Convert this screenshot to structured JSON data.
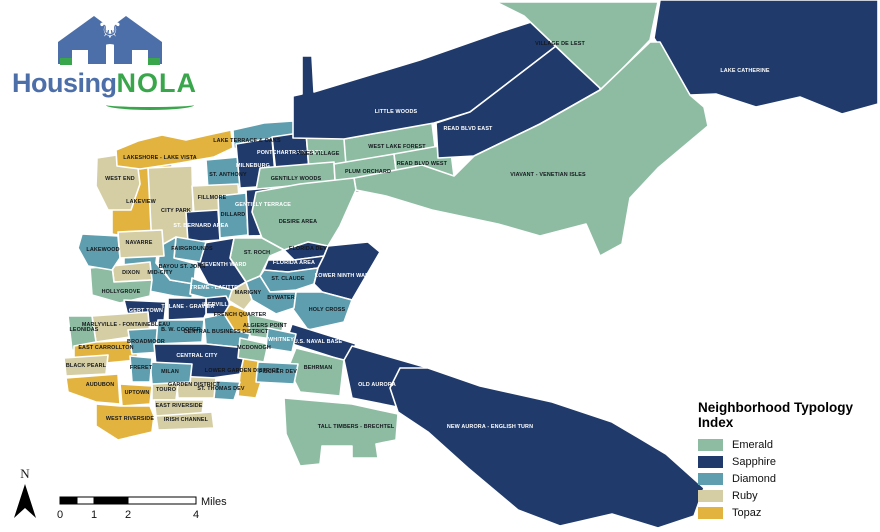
{
  "logo": {
    "brand_housing": "Housing",
    "brand_nola": "NOLA",
    "icon": "housing-nola-house-fleur-de-lis-icon",
    "blue": "#4d6fa9",
    "green": "#3aa64c"
  },
  "north_arrow": {
    "label": "N"
  },
  "scale_bar": {
    "ticks": [
      "0",
      "1",
      "2",
      "4"
    ],
    "unit": "Miles"
  },
  "legend": {
    "title": "Neighborhood Typology Index",
    "items": [
      {
        "key": "emerald",
        "label": "Emerald"
      },
      {
        "key": "sapphire",
        "label": "Sapphire"
      },
      {
        "key": "diamond",
        "label": "Diamond"
      },
      {
        "key": "ruby",
        "label": "Ruby"
      },
      {
        "key": "topaz",
        "label": "Topaz"
      }
    ]
  },
  "map": {
    "width": 880,
    "height": 532,
    "background": "#ffffff",
    "typology_colors": {
      "emerald": "#8dbca2",
      "sapphire": "#1f3a6b",
      "diamond": "#5e9eaf",
      "ruby": "#d5cea4",
      "topaz": "#e2b33e"
    },
    "label_dark": "#15181d",
    "label_light": "#ffffff",
    "regions": [
      {
        "id": "lakeview",
        "name": "LAKEVIEW",
        "typology": "topaz",
        "label": [
          141,
          203
        ],
        "white": false,
        "pts": "112,172 137,168 172,164 174,237 144,240 112,234"
      },
      {
        "id": "west-end",
        "name": "WEST END",
        "typology": "ruby",
        "label": [
          120,
          180
        ],
        "white": false,
        "pts": "97,158 136,152 140,184 131,210 108,210 96,186"
      },
      {
        "id": "lakeshore-lake-vista",
        "name": "LAKESHORE - LAKE VISTA",
        "typology": "topaz",
        "label": [
          160,
          159
        ],
        "white": false,
        "pts": "116,150 138,141 162,135 186,140 208,135 231,130 233,148 214,157 180,163 140,169 117,166"
      },
      {
        "id": "lake-terrace-oaks",
        "name": "LAKE TERRACE & OAKS",
        "typology": "diamond",
        "label": [
          247,
          142
        ],
        "white": false,
        "pts": "233,130 264,123 293,121 297,137 278,149 252,155 234,148"
      },
      {
        "id": "city-park",
        "name": "CITY PARK",
        "typology": "ruby",
        "label": [
          176,
          212
        ],
        "white": false,
        "pts": "148,168 192,166 194,250 152,248"
      },
      {
        "id": "st-anthony",
        "name": "ST. ANTHONY",
        "typology": "diamond",
        "label": [
          228,
          176
        ],
        "white": false,
        "pts": "206,160 250,156 252,188 208,190"
      },
      {
        "id": "fillmore",
        "name": "FILLMORE",
        "typology": "ruby",
        "label": [
          212,
          199
        ],
        "white": false,
        "pts": "192,186 238,184 240,212 194,214"
      },
      {
        "id": "milneburg",
        "name": "MILNEBURG",
        "typology": "sapphire",
        "label": [
          253,
          167
        ],
        "white": true,
        "pts": "236,144 272,138 276,186 240,188"
      },
      {
        "id": "pontchartrain-park",
        "name": "PONTCHARTRAIN PARK",
        "typology": "sapphire",
        "label": [
          290,
          154
        ],
        "white": true,
        "pts": "272,137 306,132 309,170 276,173"
      },
      {
        "id": "pines-village",
        "name": "PINES VILLAGE",
        "typology": "emerald",
        "label": [
          318,
          155
        ],
        "white": false,
        "pts": "306,132 350,128 352,168 309,170"
      },
      {
        "id": "gentilly-woods",
        "name": "GENTILLY WOODS",
        "typology": "emerald",
        "label": [
          296,
          180
        ],
        "white": false,
        "pts": "260,168 334,162 336,194 300,186 256,190"
      },
      {
        "id": "st-bernard-area",
        "name": "ST. BERNARD AREA",
        "typology": "sapphire",
        "label": [
          201,
          227
        ],
        "white": true,
        "pts": "186,212 218,210 220,240 188,242"
      },
      {
        "id": "dillard",
        "name": "DILLARD",
        "typology": "diamond",
        "label": [
          233,
          216
        ],
        "white": false,
        "pts": "218,196 246,193 248,235 220,238"
      },
      {
        "id": "gentilly-terrace",
        "name": "GENTILLY TERRACE",
        "typology": "sapphire",
        "label": [
          263,
          206
        ],
        "white": true,
        "pts": "246,190 290,186 292,235 248,236"
      },
      {
        "id": "west-lake-forest",
        "name": "WEST LAKE FOREST",
        "typology": "emerald",
        "label": [
          397,
          148
        ],
        "white": false,
        "pts": "344,139 432,123 436,155 396,162 346,165"
      },
      {
        "id": "plum-orchard",
        "name": "PLUM ORCHARD",
        "typology": "emerald",
        "label": [
          368,
          173
        ],
        "white": false,
        "pts": "334,164 394,154 398,186 336,196"
      },
      {
        "id": "read-blvd-west",
        "name": "READ BLVD WEST",
        "typology": "emerald",
        "label": [
          422,
          165
        ],
        "white": false,
        "pts": "394,154 450,144 454,176 398,186"
      },
      {
        "id": "little-woods",
        "name": "LITTLE WOODS",
        "typology": "sapphire",
        "label": [
          396,
          113
        ],
        "white": true,
        "pts": "293,96 302,94 302,56 312,56 314,92 420,60 500,32 578,7 592,5 590,20 470,112 434,123 344,139 293,138"
      },
      {
        "id": "read-blvd-east",
        "name": "READ BLVD EAST",
        "typology": "sapphire",
        "label": [
          468,
          130
        ],
        "white": true,
        "pts": "590,20 602,30 600,90 540,124 474,156 438,158 436,123 470,112"
      },
      {
        "id": "village-de-lest",
        "name": "VILLAGE DE LEST",
        "typology": "emerald",
        "label": [
          560,
          45
        ],
        "white": false,
        "pts": "496,2 658,2 650,40 602,90 572,62 524,16"
      },
      {
        "id": "lake-catherine",
        "name": "LAKE CATHERINE",
        "typology": "sapphire",
        "label": [
          745,
          72
        ],
        "white": true,
        "pts": "660,0 878,0 878,104 842,114 800,97 756,107 716,94 690,95 654,38"
      },
      {
        "id": "viavant-venetian-isles",
        "name": "VIAVANT - VENETIAN ISLES",
        "typology": "emerald",
        "label": [
          548,
          176
        ],
        "white": false,
        "pts": "354,178 422,165 454,176 474,156 540,124 600,90 650,42 660,42 690,95 704,107 708,126 658,168 630,198 622,244 600,256 586,224 540,236 498,224 432,210 386,196 356,190"
      },
      {
        "id": "desire-area",
        "name": "DESIRE AREA",
        "typology": "emerald",
        "label": [
          298,
          223
        ],
        "white": false,
        "pts": "256,192 300,184 354,178 356,190 340,226 328,246 308,242 284,250 262,238 252,212"
      },
      {
        "id": "st-roch",
        "name": "ST. ROCH",
        "typology": "emerald",
        "label": [
          257,
          254
        ],
        "white": false,
        "pts": "234,238 262,238 284,250 270,256 266,264 260,276 246,282 230,258"
      },
      {
        "id": "seventh-ward",
        "name": "SEVENTH WARD",
        "typology": "sapphire",
        "label": [
          224,
          266
        ],
        "white": true,
        "pts": "204,243 234,238 230,258 246,282 232,290 208,284 196,262"
      },
      {
        "id": "mid-city",
        "name": "MID-CITY",
        "typology": "diamond",
        "label": [
          160,
          274
        ],
        "white": false,
        "pts": "124,252 158,246 156,263 170,280 194,284 192,298 174,296 124,286"
      },
      {
        "id": "fairgrounds",
        "name": "FAIRGROUNDS",
        "typology": "diamond",
        "label": [
          192,
          250
        ],
        "white": false,
        "pts": "176,237 206,242 200,262 174,258"
      },
      {
        "id": "bayou-st-john",
        "name": "BAYOU ST. JOHN",
        "typology": "diamond",
        "label": [
          182,
          268
        ],
        "white": false,
        "pts": "160,246 176,237 174,258 196,264 194,284 170,280 158,263"
      },
      {
        "id": "florida-dev",
        "name": "FLORIDA DEV",
        "typology": "sapphire",
        "label": [
          308,
          250
        ],
        "white": false,
        "pts": "284,250 308,242 328,246 324,256 294,260"
      },
      {
        "id": "florida-area",
        "name": "FLORIDA AREA",
        "typology": "sapphire",
        "label": [
          294,
          264
        ],
        "white": true,
        "pts": "264,270 268,260 294,260 324,256 318,268 288,272"
      },
      {
        "id": "st-claude",
        "name": "ST. CLAUDE",
        "typology": "diamond",
        "label": [
          288,
          280
        ],
        "white": false,
        "pts": "260,276 264,270 288,272 318,268 314,284 296,290 270,292"
      },
      {
        "id": "lower-ninth-ward",
        "name": "LOWER NINTH WARD",
        "typology": "sapphire",
        "label": [
          344,
          277
        ],
        "white": true,
        "pts": "318,268 324,256 328,246 368,242 380,252 352,300 322,292 314,284"
      },
      {
        "id": "holy-cross",
        "name": "HOLY CROSS",
        "typology": "diamond",
        "label": [
          327,
          311
        ],
        "white": false,
        "pts": "296,292 322,292 352,300 344,322 308,330 292,308"
      },
      {
        "id": "bywater",
        "name": "BYWATER",
        "typology": "diamond",
        "label": [
          281,
          299
        ],
        "white": false,
        "pts": "246,282 260,276 270,292 296,292 294,308 276,314 252,300"
      },
      {
        "id": "marigny",
        "name": "MARIGNY",
        "typology": "ruby",
        "label": [
          248,
          294
        ],
        "white": false,
        "pts": "232,290 246,282 252,300 244,310 228,300"
      },
      {
        "id": "dixon",
        "name": "DIXON",
        "typology": "ruby",
        "label": [
          131,
          274
        ],
        "white": false,
        "pts": "112,266 150,262 152,280 114,282"
      },
      {
        "id": "hollygrove",
        "name": "HOLLYGROVE",
        "typology": "emerald",
        "label": [
          121,
          293
        ],
        "white": false,
        "pts": "90,268 112,266 114,282 152,280 150,296 120,303 92,295"
      },
      {
        "id": "treme-lafitte",
        "name": "TREME - LAFITTE",
        "typology": "diamond",
        "label": [
          214,
          289
        ],
        "white": true,
        "pts": "192,278 208,284 232,290 228,302 206,298 190,294"
      },
      {
        "id": "iberville",
        "name": "IBERVILLE",
        "typology": "sapphire",
        "label": [
          217,
          306
        ],
        "white": true,
        "pts": "206,298 226,296 230,304 224,314 206,314"
      },
      {
        "id": "french-quarter",
        "name": "FRENCH QUARTER",
        "typology": "topaz",
        "label": [
          240,
          316
        ],
        "white": false,
        "pts": "230,304 244,310 256,316 250,334 234,330 224,314"
      },
      {
        "id": "tulane-gravier",
        "name": "TULANE - GRAVIER",
        "typology": "sapphire",
        "label": [
          188,
          308
        ],
        "white": true,
        "pts": "168,298 206,298 206,314 204,318 168,320"
      },
      {
        "id": "gert-town",
        "name": "GERT TOWN",
        "typology": "sapphire",
        "label": [
          146,
          312
        ],
        "white": true,
        "pts": "124,300 166,302 164,322 130,324"
      },
      {
        "id": "marlyville-fontainebleau",
        "name": "MARLYVILLE - FONTAINEBLEAU",
        "typology": "ruby",
        "label": [
          126,
          326
        ],
        "white": false,
        "pts": "92,316 148,312 150,334 96,342"
      },
      {
        "id": "leonidas",
        "name": "LEONIDAS",
        "typology": "emerald",
        "label": [
          84,
          331
        ],
        "white": false,
        "pts": "68,316 92,316 96,342 94,354 72,350"
      },
      {
        "id": "east-carrollton",
        "name": "EAST CARROLLTON",
        "typology": "topaz",
        "label": [
          106,
          349
        ],
        "white": false,
        "pts": "74,346 96,342 136,340 138,360 96,364 74,358"
      },
      {
        "id": "broadmoor",
        "name": "BROADMOOR",
        "typology": "diamond",
        "label": [
          146,
          343
        ],
        "white": false,
        "pts": "128,330 164,328 162,352 132,354"
      },
      {
        "id": "b-w-cooper",
        "name": "B. W. COOPER",
        "typology": "diamond",
        "label": [
          181,
          331
        ],
        "white": false,
        "pts": "158,320 204,320 202,342 156,344"
      },
      {
        "id": "central-business-district",
        "name": "CENTRAL BUSINESS DISTRICT",
        "typology": "diamond",
        "label": [
          226,
          333
        ],
        "white": false,
        "pts": "204,318 224,314 234,330 250,334 246,348 206,344"
      },
      {
        "id": "central-city",
        "name": "CENTRAL CITY",
        "typology": "sapphire",
        "label": [
          197,
          357
        ],
        "white": true,
        "pts": "154,344 206,344 246,348 240,374 198,380 156,366"
      },
      {
        "id": "lower-garden-district",
        "name": "LOWER GARDEN DISTRICT",
        "typology": "topaz",
        "label": [
          242,
          372
        ],
        "white": false,
        "pts": "246,348 258,342 266,366 256,398 238,396 240,374"
      },
      {
        "id": "st-thomas-dev",
        "name": "ST. THOMAS DEV",
        "typology": "diamond",
        "label": [
          221,
          390
        ],
        "white": false,
        "pts": "204,380 240,382 234,400 202,398"
      },
      {
        "id": "garden-district",
        "name": "GARDEN DISTRICT",
        "typology": "ruby",
        "label": [
          194,
          386
        ],
        "white": false,
        "pts": "176,376 216,378 214,398 178,398"
      },
      {
        "id": "touro",
        "name": "TOURO",
        "typology": "ruby",
        "label": [
          166,
          391
        ],
        "white": false,
        "pts": "152,382 178,384 176,400 152,400"
      },
      {
        "id": "milan",
        "name": "MILAN",
        "typology": "diamond",
        "label": [
          170,
          373
        ],
        "white": false,
        "pts": "150,362 192,364 190,382 152,384"
      },
      {
        "id": "freret",
        "name": "FRERET",
        "typology": "diamond",
        "label": [
          141,
          369
        ],
        "white": false,
        "pts": "130,356 152,358 150,382 132,382"
      },
      {
        "id": "uptown",
        "name": "UPTOWN",
        "typology": "topaz",
        "label": [
          137,
          394
        ],
        "white": false,
        "pts": "120,384 152,386 150,404 122,406"
      },
      {
        "id": "audubon",
        "name": "AUDUBON",
        "typology": "topaz",
        "label": [
          100,
          386
        ],
        "white": false,
        "pts": "66,378 118,374 120,404 96,402 68,392"
      },
      {
        "id": "black-pearl",
        "name": "BLACK PEARL",
        "typology": "ruby",
        "label": [
          86,
          367
        ],
        "white": false,
        "pts": "64,358 108,355 106,374 66,376"
      },
      {
        "id": "east-riverside",
        "name": "EAST RIVERSIDE",
        "typology": "ruby",
        "label": [
          179,
          407
        ],
        "white": false,
        "pts": "154,400 204,400 202,414 156,416"
      },
      {
        "id": "irish-channel",
        "name": "IRISH CHANNEL",
        "typology": "ruby",
        "label": [
          186,
          421
        ],
        "white": false,
        "pts": "156,416 212,412 214,428 158,430"
      },
      {
        "id": "west-riverside",
        "name": "WEST RIVERSIDE",
        "typology": "topaz",
        "label": [
          130,
          420
        ],
        "white": false,
        "pts": "96,404 120,406 150,406 154,416 152,432 118,440 96,426"
      },
      {
        "id": "lakewood",
        "name": "LAKEWOOD",
        "typology": "diamond",
        "label": [
          103,
          251
        ],
        "white": false,
        "pts": "82,234 118,236 120,258 112,270 88,266 78,248"
      },
      {
        "id": "navarre",
        "name": "NAVARRE",
        "typology": "ruby",
        "label": [
          139,
          244
        ],
        "white": false,
        "pts": "118,232 162,230 164,256 120,258"
      },
      {
        "id": "us-naval-base",
        "name": "U.S. NAVAL BASE",
        "typology": "sapphire",
        "label": [
          318,
          343
        ],
        "white": true,
        "pts": "292,324 356,344 348,362 286,342"
      },
      {
        "id": "behrman",
        "name": "BEHRMAN",
        "typology": "emerald",
        "label": [
          318,
          369
        ],
        "white": false,
        "pts": "296,348 344,360 340,396 300,392 288,368"
      },
      {
        "id": "old-aurora",
        "name": "OLD AURORA",
        "typology": "sapphire",
        "label": [
          377,
          386
        ],
        "white": true,
        "pts": "352,346 428,368 422,412 352,398 344,360"
      },
      {
        "id": "algiers-point",
        "name": "ALGIERS POINT",
        "typology": "emerald",
        "label": [
          265,
          327
        ],
        "white": false,
        "pts": "248,314 284,322 280,340 250,336"
      },
      {
        "id": "mcdonogh",
        "name": "MCDONOGH",
        "typology": "emerald",
        "label": [
          254,
          349
        ],
        "white": false,
        "pts": "240,338 268,344 264,362 238,358"
      },
      {
        "id": "whitney",
        "name": "WHITNEY",
        "typology": "diamond",
        "label": [
          281,
          341
        ],
        "white": true,
        "pts": "268,328 296,334 292,352 266,348"
      },
      {
        "id": "fischer-dev",
        "name": "FISCHER DEV",
        "typology": "diamond",
        "label": [
          278,
          373
        ],
        "white": false,
        "pts": "258,362 298,364 294,384 256,382"
      },
      {
        "id": "tall-timbers-brechtel",
        "name": "TALL TIMBERS - BRECHTEL",
        "typology": "emerald",
        "label": [
          356,
          428
        ],
        "white": false,
        "pts": "284,398 352,404 398,414 396,440 376,444 378,458 352,458 352,446 322,446 320,464 300,466 286,434"
      },
      {
        "id": "new-aurora-english-turn",
        "name": "NEW AURORA - ENGLISH TURN",
        "typology": "sapphire",
        "label": [
          490,
          428
        ],
        "white": true,
        "pts": "400,368 428,368 480,386 552,402 612,422 666,454 704,488 694,516 658,528 612,514 560,526 518,510 468,468 428,432 398,412 390,388"
      }
    ]
  }
}
